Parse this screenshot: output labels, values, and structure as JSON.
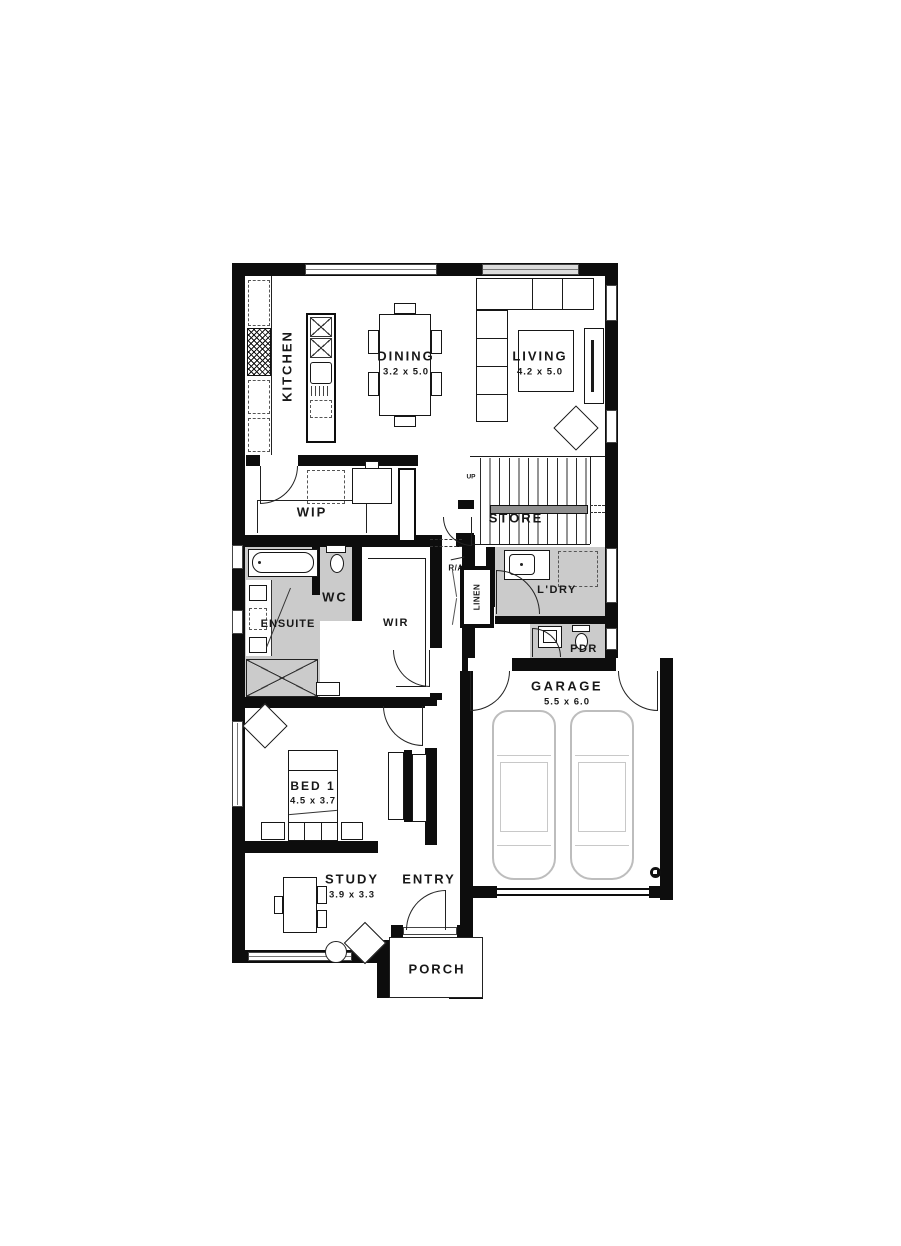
{
  "plan": {
    "title": "Single storey floor plan",
    "rooms": {
      "kitchen": {
        "label": "KITCHEN"
      },
      "dining": {
        "label": "DINING",
        "dims": "3.2 x 5.0"
      },
      "living": {
        "label": "LIVING",
        "dims": "4.2 x 5.0"
      },
      "wip": {
        "label": "WIP"
      },
      "store": {
        "label": "STORE"
      },
      "stairs": {
        "direction_label": "UP"
      },
      "return_air": {
        "label": "R/A"
      },
      "linen": {
        "label": "LINEN"
      },
      "laundry": {
        "label": "L'DRY"
      },
      "powder": {
        "label": "PDR"
      },
      "ensuite": {
        "label": "ENSUITE"
      },
      "wc": {
        "label": "WC"
      },
      "wir": {
        "label": "WIR"
      },
      "garage": {
        "label": "GARAGE",
        "dims": "5.5 x 6.0"
      },
      "bed1": {
        "label": "BED 1",
        "dims": "4.5 x 3.7"
      },
      "study": {
        "label": "STUDY",
        "dims": "3.9 x 3.3"
      },
      "entry": {
        "label": "ENTRY"
      },
      "porch": {
        "label": "PORCH"
      }
    },
    "colors": {
      "wall": "#0d0d0d",
      "wet_area_fill": "#cbcbcb",
      "car_outline": "#bdbdbd"
    }
  }
}
